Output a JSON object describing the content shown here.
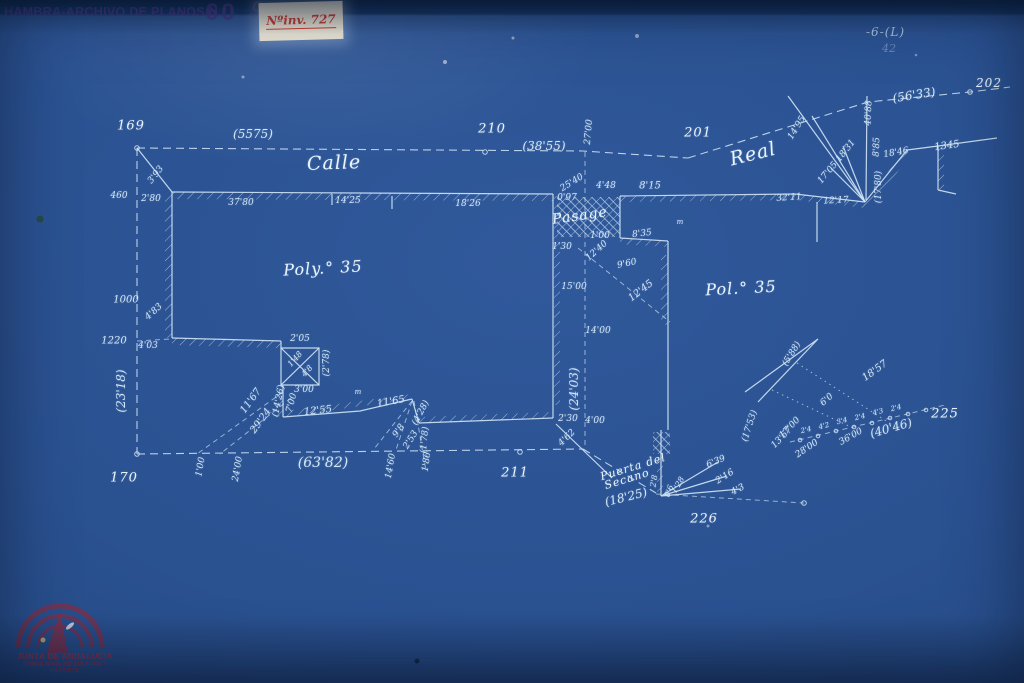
{
  "colors": {
    "paper": "#2a5190",
    "paper-dark": "#15325a",
    "ink": "#d3e6f6",
    "ink-strong": "#eaf4fc",
    "header-ink": "#4b3a8f",
    "label-bg": "#e9e5d6",
    "label-red": "#cf4035",
    "stamp-red": "#973044"
  },
  "header": {
    "archive_stamp": "HAMBRA-ARCHIVO DE PLANOS N.º",
    "stamp_number": "60",
    "stamp_suffix": "9",
    "inventory_label": "Nºinv. 727",
    "sheet_ref": "-6-(L)",
    "sheet_ref_note": "42"
  },
  "junta_stamp": {
    "line1": "JUNTA DE ANDALUCIA",
    "line2": "CONSEJERÍA DE CULTURA Y DEPORTE"
  },
  "plan": {
    "labels": [
      {
        "t": "169",
        "x": 131,
        "y": 126,
        "s": 13,
        "c": "big"
      },
      {
        "t": "(5575)",
        "x": 253,
        "y": 134,
        "s": 12
      },
      {
        "t": "Calle",
        "x": 334,
        "y": 163,
        "r": -2,
        "s": 19,
        "c": "script"
      },
      {
        "t": "210",
        "x": 492,
        "y": 129,
        "s": 13,
        "c": "big"
      },
      {
        "t": "(38'55)",
        "x": 544,
        "y": 146,
        "s": 12
      },
      {
        "t": "201",
        "x": 698,
        "y": 133,
        "s": 13,
        "c": "big"
      },
      {
        "t": "Real",
        "x": 753,
        "y": 154,
        "r": -14,
        "s": 19,
        "c": "script"
      },
      {
        "t": "(56'33)",
        "x": 914,
        "y": 95,
        "r": -9,
        "s": 12
      },
      {
        "t": "202",
        "x": 989,
        "y": 83,
        "s": 12,
        "c": "big"
      },
      {
        "t": "3'93",
        "x": 156,
        "y": 175,
        "r": -52,
        "s": 9
      },
      {
        "t": "460",
        "x": 119,
        "y": 196,
        "s": 9
      },
      {
        "t": "2'80",
        "x": 151,
        "y": 199,
        "s": 9
      },
      {
        "t": "37'80",
        "x": 241,
        "y": 203,
        "s": 9
      },
      {
        "t": "14'25",
        "x": 348,
        "y": 201,
        "s": 9
      },
      {
        "t": "18'26",
        "x": 468,
        "y": 204,
        "s": 9
      },
      {
        "t": "27'00",
        "x": 589,
        "y": 132,
        "r": -85,
        "s": 9
      },
      {
        "t": "25'40",
        "x": 572,
        "y": 183,
        "r": -32,
        "s": 9
      },
      {
        "t": "0'97",
        "x": 567,
        "y": 198,
        "s": 9
      },
      {
        "t": "4'48",
        "x": 606,
        "y": 186,
        "s": 9
      },
      {
        "t": "8'15",
        "x": 650,
        "y": 186,
        "s": 10
      },
      {
        "t": "Pasage",
        "x": 580,
        "y": 216,
        "r": -8,
        "s": 14,
        "c": "script"
      },
      {
        "t": "m",
        "x": 680,
        "y": 222,
        "s": 7
      },
      {
        "t": "1'00",
        "x": 600,
        "y": 236,
        "s": 9
      },
      {
        "t": "8'35",
        "x": 642,
        "y": 234,
        "r": -6,
        "s": 9
      },
      {
        "t": "1'30",
        "x": 562,
        "y": 247,
        "s": 9
      },
      {
        "t": "12'40",
        "x": 597,
        "y": 251,
        "r": -42,
        "s": 9
      },
      {
        "t": "9'60",
        "x": 627,
        "y": 264,
        "r": -12,
        "s": 9
      },
      {
        "t": "15'00",
        "x": 574,
        "y": 287,
        "s": 9
      },
      {
        "t": "12'45",
        "x": 641,
        "y": 291,
        "r": -38,
        "s": 10
      },
      {
        "t": "14'00",
        "x": 598,
        "y": 331,
        "s": 9
      },
      {
        "t": "Poly.° 35",
        "x": 323,
        "y": 268,
        "r": -3,
        "s": 16,
        "c": "script"
      },
      {
        "t": "Pol.° 35",
        "x": 741,
        "y": 288,
        "r": -3,
        "s": 16,
        "c": "script"
      },
      {
        "t": "1000",
        "x": 126,
        "y": 300,
        "s": 10
      },
      {
        "t": "4'83",
        "x": 154,
        "y": 312,
        "r": -42,
        "s": 9
      },
      {
        "t": "1220",
        "x": 114,
        "y": 341,
        "s": 10
      },
      {
        "t": "4'03",
        "x": 148,
        "y": 346,
        "s": 9
      },
      {
        "t": "(23'18)",
        "x": 121,
        "y": 391,
        "r": -90,
        "s": 12
      },
      {
        "t": "170",
        "x": 124,
        "y": 478,
        "s": 13,
        "c": "big"
      },
      {
        "t": "2'05",
        "x": 300,
        "y": 339,
        "s": 9
      },
      {
        "t": "1'48",
        "x": 295,
        "y": 359,
        "r": -48,
        "s": 8
      },
      {
        "t": "4'8",
        "x": 307,
        "y": 371,
        "r": -48,
        "s": 8
      },
      {
        "t": "(2'78)",
        "x": 327,
        "y": 363,
        "r": -90,
        "s": 9
      },
      {
        "t": "3'00",
        "x": 304,
        "y": 390,
        "s": 9
      },
      {
        "t": "7'00",
        "x": 292,
        "y": 403,
        "r": -75,
        "s": 9
      },
      {
        "t": "(14'26)",
        "x": 279,
        "y": 401,
        "r": -78,
        "s": 9
      },
      {
        "t": "12'55",
        "x": 318,
        "y": 411,
        "r": -6,
        "s": 10
      },
      {
        "t": "m",
        "x": 358,
        "y": 392,
        "s": 7
      },
      {
        "t": "11'67",
        "x": 251,
        "y": 401,
        "r": -54,
        "s": 10
      },
      {
        "t": "29'24",
        "x": 261,
        "y": 421,
        "r": -54,
        "s": 10
      },
      {
        "t": "11'65",
        "x": 391,
        "y": 402,
        "r": -10,
        "s": 10
      },
      {
        "t": "(4'28)",
        "x": 421,
        "y": 413,
        "r": -62,
        "s": 9
      },
      {
        "t": "9'8",
        "x": 399,
        "y": 431,
        "r": -55,
        "s": 9
      },
      {
        "t": "2'53",
        "x": 411,
        "y": 440,
        "r": -58,
        "s": 9
      },
      {
        "t": "(1'78)",
        "x": 425,
        "y": 440,
        "r": -85,
        "s": 9
      },
      {
        "t": "1'86",
        "x": 427,
        "y": 462,
        "r": -82,
        "s": 9
      },
      {
        "t": "14'60",
        "x": 391,
        "y": 466,
        "r": -80,
        "s": 9
      },
      {
        "t": "1'00",
        "x": 201,
        "y": 467,
        "r": -80,
        "s": 9
      },
      {
        "t": "24'00",
        "x": 238,
        "y": 469,
        "r": -80,
        "s": 9
      },
      {
        "t": "(63'82)",
        "x": 323,
        "y": 463,
        "s": 14
      },
      {
        "t": "211",
        "x": 515,
        "y": 473,
        "s": 13,
        "c": "big"
      },
      {
        "t": "(24'03)",
        "x": 574,
        "y": 389,
        "r": -90,
        "s": 12
      },
      {
        "t": "2'30",
        "x": 568,
        "y": 419,
        "s": 9
      },
      {
        "t": "4'00",
        "x": 595,
        "y": 421,
        "s": 9
      },
      {
        "t": "4'62",
        "x": 567,
        "y": 438,
        "r": -44,
        "s": 9
      },
      {
        "t": "Puerta del",
        "x": 633,
        "y": 467,
        "r": -17,
        "s": 11,
        "c": "script"
      },
      {
        "t": "Secano",
        "x": 627,
        "y": 479,
        "r": -17,
        "s": 11,
        "c": "script"
      },
      {
        "t": "(18'25)",
        "x": 626,
        "y": 497,
        "r": -14,
        "s": 12
      },
      {
        "t": "226",
        "x": 704,
        "y": 519,
        "s": 13,
        "c": "big"
      },
      {
        "t": "6'39",
        "x": 716,
        "y": 462,
        "r": -22,
        "s": 9
      },
      {
        "t": "2'16",
        "x": 725,
        "y": 477,
        "r": -32,
        "s": 9
      },
      {
        "t": "4'3",
        "x": 738,
        "y": 490,
        "r": -28,
        "s": 9
      },
      {
        "t": "1'28",
        "x": 678,
        "y": 485,
        "r": -60,
        "s": 8
      },
      {
        "t": "0'6",
        "x": 669,
        "y": 491,
        "r": -70,
        "s": 8
      },
      {
        "t": "2'8",
        "x": 654,
        "y": 481,
        "r": -80,
        "s": 8
      },
      {
        "t": "32'11",
        "x": 789,
        "y": 198,
        "r": -4,
        "s": 9
      },
      {
        "t": "12'17",
        "x": 836,
        "y": 201,
        "r": -3,
        "s": 9
      },
      {
        "t": "14'95",
        "x": 797,
        "y": 128,
        "r": -58,
        "s": 9
      },
      {
        "t": "18'31",
        "x": 846,
        "y": 151,
        "r": -52,
        "s": 9
      },
      {
        "t": "17'05",
        "x": 828,
        "y": 173,
        "r": -50,
        "s": 9
      },
      {
        "t": "40'88",
        "x": 869,
        "y": 113,
        "r": -88,
        "s": 9
      },
      {
        "t": "8'85",
        "x": 877,
        "y": 147,
        "r": -88,
        "s": 9
      },
      {
        "t": "(17'80)",
        "x": 879,
        "y": 187,
        "r": -90,
        "s": 9
      },
      {
        "t": "18'46",
        "x": 896,
        "y": 153,
        "r": -10,
        "s": 9
      },
      {
        "t": "1345",
        "x": 947,
        "y": 146,
        "r": -8,
        "s": 10
      },
      {
        "t": "(5'88)",
        "x": 792,
        "y": 354,
        "r": -58,
        "s": 9
      },
      {
        "t": "18'57",
        "x": 875,
        "y": 371,
        "r": -36,
        "s": 10
      },
      {
        "t": "6'0",
        "x": 827,
        "y": 400,
        "r": -42,
        "s": 9
      },
      {
        "t": "(17'53)",
        "x": 750,
        "y": 426,
        "r": -72,
        "s": 9
      },
      {
        "t": "17'00",
        "x": 790,
        "y": 428,
        "r": -46,
        "s": 9
      },
      {
        "t": "13'67",
        "x": 782,
        "y": 438,
        "r": -46,
        "s": 9
      },
      {
        "t": "36'00",
        "x": 851,
        "y": 437,
        "r": -30,
        "s": 9
      },
      {
        "t": "28'00",
        "x": 807,
        "y": 449,
        "r": -34,
        "s": 9
      },
      {
        "t": "(40'46)",
        "x": 891,
        "y": 428,
        "r": -16,
        "s": 12
      },
      {
        "t": "225",
        "x": 945,
        "y": 414,
        "s": 13,
        "c": "big"
      },
      {
        "t": "2'4",
        "x": 806,
        "y": 430,
        "r": -14,
        "s": 7
      },
      {
        "t": "4'2",
        "x": 824,
        "y": 426,
        "r": -14,
        "s": 7
      },
      {
        "t": "3'4",
        "x": 842,
        "y": 421,
        "r": -14,
        "s": 7
      },
      {
        "t": "2'4",
        "x": 860,
        "y": 417,
        "r": -14,
        "s": 7
      },
      {
        "t": "4'3",
        "x": 878,
        "y": 412,
        "r": -14,
        "s": 7
      },
      {
        "t": "2'4",
        "x": 896,
        "y": 408,
        "r": -14,
        "s": 7
      }
    ]
  }
}
